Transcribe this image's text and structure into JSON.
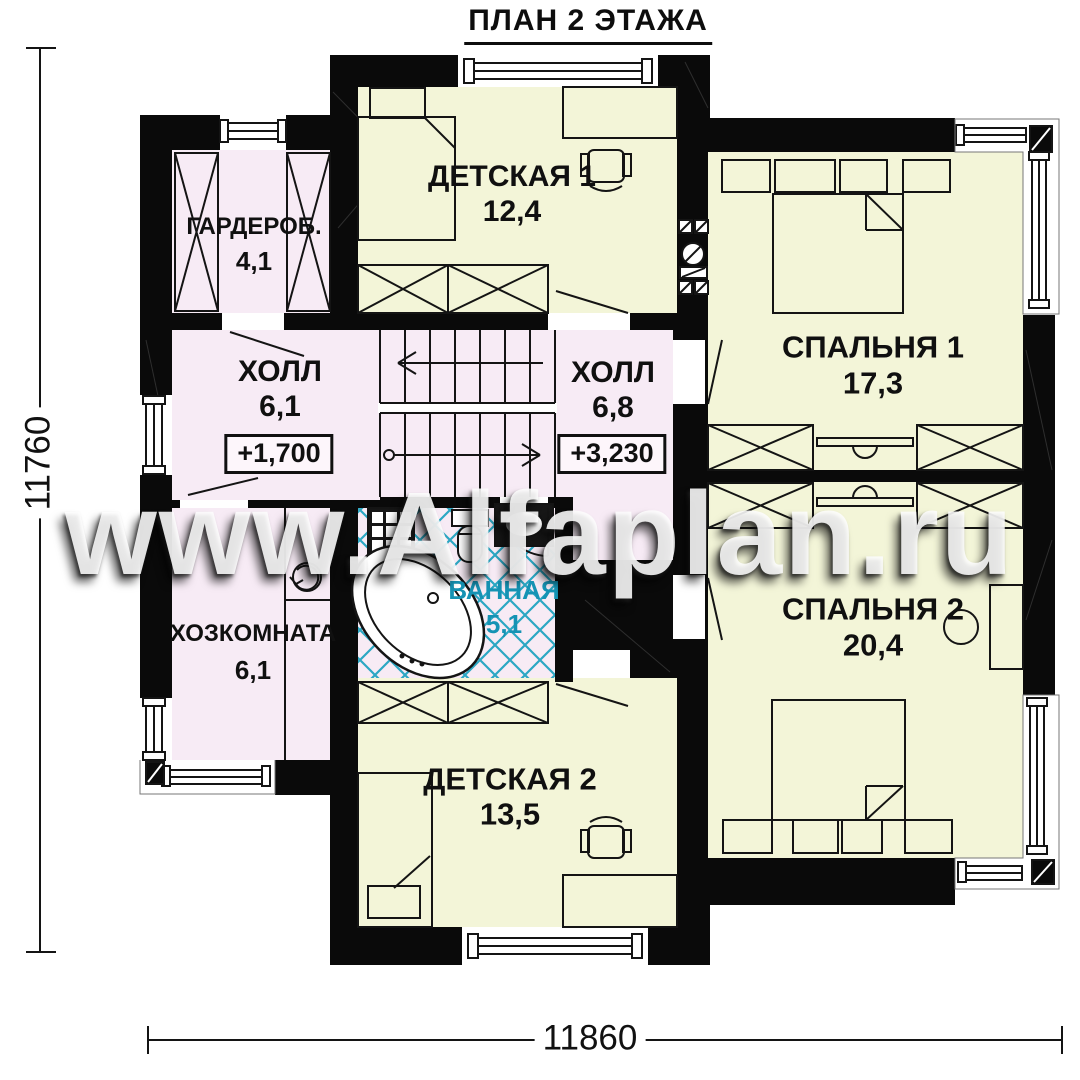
{
  "title": "ПЛАН 2 ЭТАЖА",
  "watermark": "www.Alfaplan.ru",
  "dimensions": {
    "height_total": "11760",
    "width_total": "11860"
  },
  "rooms": {
    "wardrobe": {
      "name": "ГАРДЕРОБ.",
      "area": "4,1"
    },
    "kids1": {
      "name": "ДЕТСКАЯ 1",
      "area": "12,4"
    },
    "bedroom1": {
      "name": "СПАЛЬНЯ 1",
      "area": "17,3"
    },
    "hall1": {
      "name": "ХОЛЛ",
      "area": "6,1",
      "elevation": "+1,700"
    },
    "hall2": {
      "name": "ХОЛЛ",
      "area": "6,8",
      "elevation": "+3,230"
    },
    "utility": {
      "name": "ХОЗКОМНАТА",
      "area": "6,1"
    },
    "bathroom": {
      "name": "ВАННАЯ",
      "area": "5,1"
    },
    "bedroom2": {
      "name": "СПАЛЬНЯ 2",
      "area": "20,4"
    },
    "kids2": {
      "name": "ДЕТСКАЯ 2",
      "area": "13,5"
    }
  },
  "colors": {
    "wall": "#0a0a0a",
    "room_yellow": "#f3f5d8",
    "room_pink": "#f7ebf5",
    "tile_accent": "#2ba7c3",
    "bathroom_label": "#1593b4"
  }
}
